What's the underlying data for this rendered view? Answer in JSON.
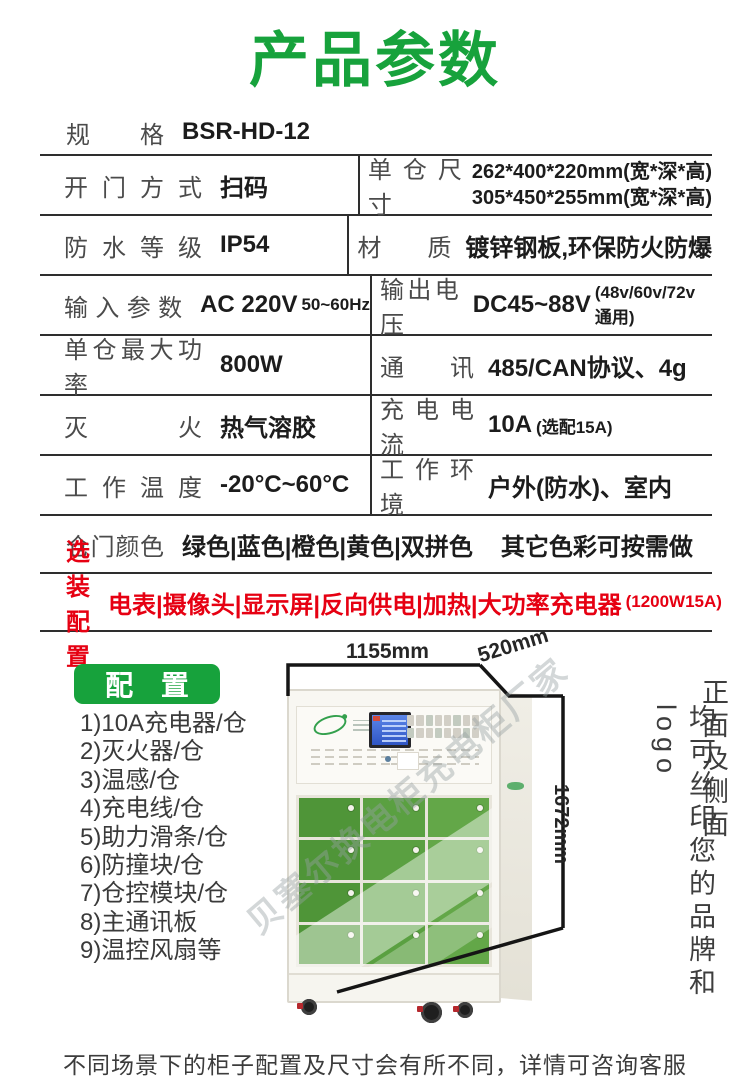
{
  "page": {
    "accent_green": "#17a23c",
    "accent_red": "#e60012",
    "door_green": "#579b3e",
    "line_color": "#2e2e2e"
  },
  "header": {
    "title": "产品参数"
  },
  "spec_table": {
    "rows": [
      {
        "label": "规 格",
        "value": "BSR-HD-12"
      },
      {
        "left": {
          "label": "开门方式",
          "value": "扫码"
        },
        "right": {
          "label": "单仓尺寸",
          "line1": "262*400*220mm(宽*深*高)",
          "line2": "305*450*255mm(宽*深*高)"
        }
      },
      {
        "left": {
          "label": "防水等级",
          "value": "IP54"
        },
        "right": {
          "label": "材 质",
          "value": "镀锌钢板,环保防火防爆"
        }
      },
      {
        "left": {
          "label": "输入参数",
          "value": "AC 220V",
          "value_small": "50~60Hz"
        },
        "right": {
          "label": "输出电压",
          "value": "DC45~88V",
          "value_small": "(48v/60v/72v通用)"
        }
      },
      {
        "left": {
          "label": "单仓最大功率",
          "value": "800W"
        },
        "right": {
          "label": "通 讯",
          "value": "485/CAN协议、4g"
        }
      },
      {
        "left": {
          "label": "灭 火",
          "value": "热气溶胶"
        },
        "right": {
          "label": "充电电流",
          "value": "10A",
          "value_small": "(选配15A)"
        }
      },
      {
        "left": {
          "label": "工作温度",
          "value": "-20°C~60°C"
        },
        "right": {
          "label": "工作环境",
          "value": "户外(防水)、室内"
        }
      },
      {
        "label": "仓门颜色",
        "value": "绿色|蓝色|橙色|黄色|双拼色",
        "note": "其它色彩可按需做"
      },
      {
        "label": "选装配置",
        "value": "电表|摄像头|显示屏|反向供电|加热|大功率充电器",
        "value_small": "(1200W15A)"
      }
    ]
  },
  "config": {
    "badge_label": "配 置",
    "items": [
      "1)10A充电器/仓",
      "2)灭火器/仓",
      "3)温感/仓",
      "4)充电线/仓",
      "5)助力滑条/仓",
      "6)防撞块/仓",
      "7)仓控模块/仓",
      "8)主通讯板",
      "9)温控风扇等"
    ]
  },
  "figure": {
    "dimensions": {
      "width": "1155mm",
      "depth": "520mm",
      "height": "1672mm"
    },
    "watermark": "贝塞尔换电柜充电柜厂家",
    "side_note_right": "正面及侧面",
    "side_note_left": "均可丝印您的品牌和logo"
  },
  "footer": {
    "note": "不同场景下的柜子配置及尺寸会有所不同，详情可咨询客服"
  }
}
